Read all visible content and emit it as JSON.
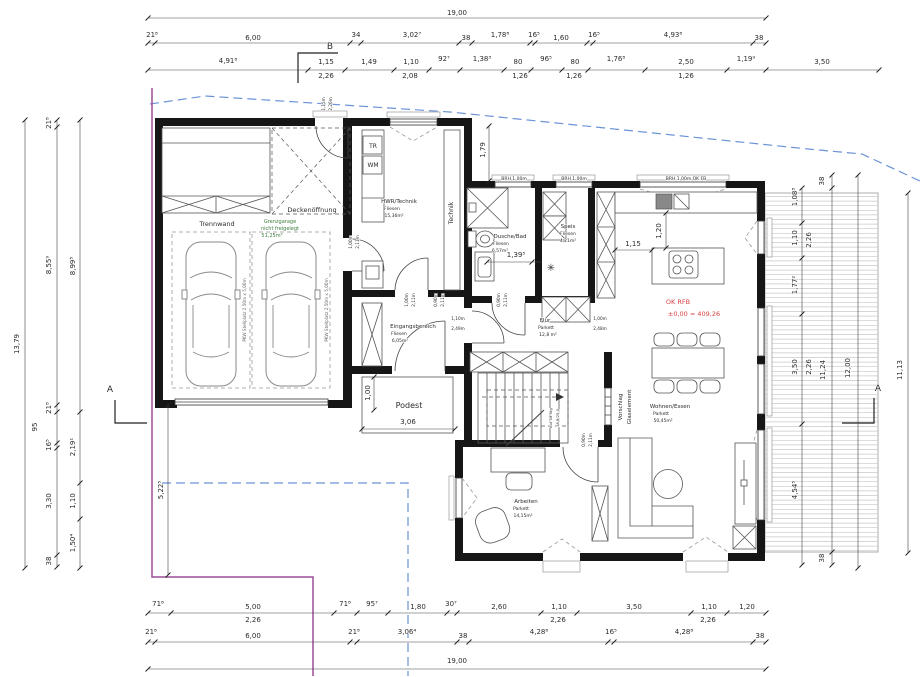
{
  "drawing": {
    "type": "floor-plan",
    "level_note": "OK RFB ±0,00 = 409,26",
    "rooms": [
      {
        "name": "Grenzgarage",
        "note": "nicht freigelegt",
        "area": "51,25m²"
      },
      {
        "name": "HWR/Technik",
        "floor": "Fliesen",
        "area": "15,36m²"
      },
      {
        "name": "Dusche/Bad",
        "floor": "Fliesen",
        "area": "6,57m²"
      },
      {
        "name": "Speis",
        "floor": "Fliesen",
        "area": "4,21m²"
      },
      {
        "name": "Flur",
        "floor": "Parkett",
        "area": "12,8 m²"
      },
      {
        "name": "Eingangsbereich",
        "floor": "Fliesen",
        "area": "6,05m²"
      },
      {
        "name": "Wohnen/Essen",
        "floor": "Parkett",
        "area": "50,45m²"
      },
      {
        "name": "Arbeiten",
        "floor": "Parkett",
        "area": "14,15m²"
      }
    ],
    "colors": {
      "boundary_purple": "#9b4f96",
      "site_blue": "#6b93d6",
      "note_red": "#d84040",
      "garage_green": "#3e7d3e"
    }
  },
  "labels": [
    {
      "t": "19,00",
      "x": 457,
      "y": 15
    },
    {
      "t": "21⁸",
      "x": 152,
      "y": 37
    },
    {
      "t": "6,00",
      "x": 253,
      "y": 40
    },
    {
      "t": "34",
      "x": 356,
      "y": 37
    },
    {
      "t": "3,02⁷",
      "x": 412,
      "y": 37
    },
    {
      "t": "38",
      "x": 466,
      "y": 40
    },
    {
      "t": "1,78⁸",
      "x": 500,
      "y": 37
    },
    {
      "t": "16⁵",
      "x": 534,
      "y": 37
    },
    {
      "t": "1,60",
      "x": 561,
      "y": 40
    },
    {
      "t": "16⁵",
      "x": 594,
      "y": 37
    },
    {
      "t": "4,93⁸",
      "x": 673,
      "y": 37
    },
    {
      "t": "38",
      "x": 759,
      "y": 40
    },
    {
      "t": "B",
      "x": 330,
      "y": 49,
      "s": 9,
      "n": "section-marker-b-label"
    },
    {
      "t": "4,91⁸",
      "x": 228,
      "y": 63
    },
    {
      "t": "1,15",
      "x": 326,
      "y": 64
    },
    {
      "t": "2,26",
      "x": 326,
      "y": 78
    },
    {
      "t": "1,49",
      "x": 369,
      "y": 64
    },
    {
      "t": "1,10",
      "x": 411,
      "y": 64
    },
    {
      "t": "2,08",
      "x": 410,
      "y": 78
    },
    {
      "t": "92⁷",
      "x": 444,
      "y": 61
    },
    {
      "t": "1,38³",
      "x": 482,
      "y": 61
    },
    {
      "t": "80",
      "x": 518,
      "y": 64
    },
    {
      "t": "1,26",
      "x": 520,
      "y": 78
    },
    {
      "t": "96⁵",
      "x": 546,
      "y": 61
    },
    {
      "t": "80",
      "x": 575,
      "y": 64
    },
    {
      "t": "1,26",
      "x": 574,
      "y": 78
    },
    {
      "t": "1,76⁸",
      "x": 616,
      "y": 61
    },
    {
      "t": "2,50",
      "x": 686,
      "y": 64
    },
    {
      "t": "1,26",
      "x": 686,
      "y": 78
    },
    {
      "t": "1,19⁹",
      "x": 746,
      "y": 61
    },
    {
      "t": "3,50",
      "x": 822,
      "y": 64
    },
    {
      "t": "13,79",
      "x": 19,
      "y": 344,
      "r": -90
    },
    {
      "t": "21⁸",
      "x": 51,
      "y": 123,
      "r": -90
    },
    {
      "t": "8,55⁹",
      "x": 51,
      "y": 265,
      "r": -90
    },
    {
      "t": "21⁸",
      "x": 51,
      "y": 408,
      "r": -90
    },
    {
      "t": "95",
      "x": 37,
      "y": 427,
      "r": -90
    },
    {
      "t": "16⁵",
      "x": 51,
      "y": 445,
      "r": -90
    },
    {
      "t": "3,30",
      "x": 51,
      "y": 501,
      "r": -90
    },
    {
      "t": "38",
      "x": 51,
      "y": 561,
      "r": -90
    },
    {
      "t": "8,99⁵",
      "x": 75,
      "y": 266,
      "r": -90
    },
    {
      "t": "2,19¹",
      "x": 75,
      "y": 447,
      "r": -90
    },
    {
      "t": "1,10",
      "x": 75,
      "y": 501,
      "r": -90
    },
    {
      "t": "1,50⁴",
      "x": 75,
      "y": 543,
      "r": -90
    },
    {
      "t": "A",
      "x": 110,
      "y": 392,
      "s": 9,
      "n": "section-marker-a-label"
    },
    {
      "t": "5,22⁵",
      "x": 163,
      "y": 490,
      "r": -90
    },
    {
      "t": "38",
      "x": 824,
      "y": 181,
      "r": -90
    },
    {
      "t": "1,08³",
      "x": 797,
      "y": 197,
      "r": -90
    },
    {
      "t": "1,10",
      "x": 797,
      "y": 238,
      "r": -90
    },
    {
      "t": "2,26",
      "x": 811,
      "y": 240,
      "r": -90
    },
    {
      "t": "1,77²",
      "x": 797,
      "y": 285,
      "r": -90
    },
    {
      "t": "3,50",
      "x": 797,
      "y": 367,
      "r": -90
    },
    {
      "t": "2,26",
      "x": 811,
      "y": 367,
      "r": -90
    },
    {
      "t": "11,24",
      "x": 825,
      "y": 370,
      "r": -90
    },
    {
      "t": "12,00",
      "x": 850,
      "y": 368,
      "r": -90
    },
    {
      "t": "11,13",
      "x": 902,
      "y": 370,
      "r": -90
    },
    {
      "t": "4,54⁵",
      "x": 797,
      "y": 490,
      "r": -90
    },
    {
      "t": "38",
      "x": 824,
      "y": 558,
      "r": -90
    },
    {
      "t": "A",
      "x": 878,
      "y": 391,
      "s": 9,
      "n": "section-marker-a-label"
    },
    {
      "t": "71⁸",
      "x": 158,
      "y": 606
    },
    {
      "t": "5,00",
      "x": 253,
      "y": 609
    },
    {
      "t": "2,26",
      "x": 253,
      "y": 622
    },
    {
      "t": "71⁸",
      "x": 345,
      "y": 606
    },
    {
      "t": "95⁷",
      "x": 372,
      "y": 606
    },
    {
      "t": "1,80",
      "x": 418,
      "y": 609
    },
    {
      "t": "30⁷",
      "x": 451,
      "y": 606
    },
    {
      "t": "2,60",
      "x": 499,
      "y": 609
    },
    {
      "t": "1,10",
      "x": 559,
      "y": 609
    },
    {
      "t": "2,26",
      "x": 558,
      "y": 622
    },
    {
      "t": "3,50",
      "x": 634,
      "y": 609
    },
    {
      "t": "1,10",
      "x": 709,
      "y": 609
    },
    {
      "t": "2,26",
      "x": 708,
      "y": 622
    },
    {
      "t": "1,20",
      "x": 747,
      "y": 609
    },
    {
      "t": "21⁸",
      "x": 151,
      "y": 634
    },
    {
      "t": "6,00",
      "x": 253,
      "y": 638
    },
    {
      "t": "21⁸",
      "x": 354,
      "y": 634
    },
    {
      "t": "3,06⁴",
      "x": 407,
      "y": 634
    },
    {
      "t": "38",
      "x": 463,
      "y": 638
    },
    {
      "t": "4,28⁸",
      "x": 539,
      "y": 634
    },
    {
      "t": "16⁵",
      "x": 611,
      "y": 634
    },
    {
      "t": "4,28⁸",
      "x": 684,
      "y": 634
    },
    {
      "t": "38",
      "x": 760,
      "y": 638
    },
    {
      "t": "19,00",
      "x": 457,
      "y": 663
    },
    {
      "t": "1,79",
      "x": 485,
      "y": 150,
      "r": -90
    },
    {
      "t": "1,20",
      "x": 661,
      "y": 231,
      "r": -90
    },
    {
      "t": "1,15",
      "x": 633,
      "y": 246
    },
    {
      "t": "1,39⁵",
      "x": 516,
      "y": 257
    },
    {
      "t": "1,00",
      "x": 370,
      "y": 393,
      "r": -90
    },
    {
      "t": "Podest",
      "x": 409,
      "y": 408,
      "s": 8,
      "n": "room-label"
    },
    {
      "t": "3,06",
      "x": 408,
      "y": 424
    },
    {
      "t": "OK RFB",
      "x": 678,
      "y": 304,
      "s": 6.5,
      "c": "#d84040",
      "n": "level-note"
    },
    {
      "t": "±0,00 = 409,26",
      "x": 694,
      "y": 316,
      "s": 6.5,
      "c": "#d84040",
      "n": "level-note"
    },
    {
      "t": "Trennwand",
      "x": 217,
      "y": 226,
      "s": 6.5,
      "n": "room-label"
    },
    {
      "t": "Grenzgarage",
      "x": 280,
      "y": 223,
      "s": 5,
      "c": "#3e7d3e",
      "n": "room-label"
    },
    {
      "t": "nicht freigelegt",
      "x": 280,
      "y": 230,
      "s": 5,
      "c": "#3e7d3e",
      "n": "room-label"
    },
    {
      "t": "51,25m²",
      "x": 272,
      "y": 237,
      "s": 5,
      "c": "#3e7d3e",
      "n": "room-label"
    },
    {
      "t": "Deckenöffnung",
      "x": 312,
      "y": 212,
      "s": 6.5,
      "n": "room-label"
    },
    {
      "t": "HWR/Technik",
      "x": 399,
      "y": 203,
      "s": 5.5,
      "n": "room-label"
    },
    {
      "t": "Fliesen",
      "x": 392,
      "y": 210,
      "s": 4.5,
      "n": "room-label"
    },
    {
      "t": "15,36m²",
      "x": 394,
      "y": 217,
      "s": 4.5,
      "n": "room-label"
    },
    {
      "t": "Technik",
      "x": 453,
      "y": 213,
      "r": -90,
      "s": 6,
      "n": "room-label"
    },
    {
      "t": "TR",
      "x": 373,
      "y": 148,
      "s": 6,
      "n": "fixture-label"
    },
    {
      "t": "WM",
      "x": 373,
      "y": 167,
      "s": 6,
      "n": "fixture-label"
    },
    {
      "t": "Dusche/Bad",
      "x": 510,
      "y": 238,
      "s": 5.5,
      "n": "room-label"
    },
    {
      "t": "Fliesen",
      "x": 501,
      "y": 245,
      "s": 4.5,
      "n": "room-label"
    },
    {
      "t": "6,57m²",
      "x": 500,
      "y": 252,
      "s": 4.5,
      "n": "room-label"
    },
    {
      "t": "Speis",
      "x": 568,
      "y": 228,
      "s": 5.5,
      "n": "room-label"
    },
    {
      "t": "Fliesen",
      "x": 568,
      "y": 235,
      "s": 4.5,
      "n": "room-label"
    },
    {
      "t": "4,21m²",
      "x": 568,
      "y": 242,
      "s": 4.5,
      "n": "room-label"
    },
    {
      "t": "Flur",
      "x": 545,
      "y": 322,
      "s": 5.5,
      "n": "room-label"
    },
    {
      "t": "Parkett",
      "x": 546,
      "y": 329,
      "s": 4.5,
      "n": "room-label"
    },
    {
      "t": "12,8 m²",
      "x": 548,
      "y": 336,
      "s": 4.5,
      "n": "room-label"
    },
    {
      "t": "Eingangsbereich",
      "x": 413,
      "y": 328,
      "s": 5.5,
      "n": "room-label"
    },
    {
      "t": "Fliesen",
      "x": 399,
      "y": 335,
      "s": 4.5,
      "n": "room-label"
    },
    {
      "t": "6,05m²",
      "x": 400,
      "y": 342,
      "s": 4.5,
      "n": "room-label"
    },
    {
      "t": "Wohnen/Essen",
      "x": 670,
      "y": 408,
      "s": 5.5,
      "n": "room-label"
    },
    {
      "t": "Parkett",
      "x": 661,
      "y": 415,
      "s": 4.5,
      "n": "room-label"
    },
    {
      "t": "50,45m²",
      "x": 663,
      "y": 422,
      "s": 4.5,
      "n": "room-label"
    },
    {
      "t": "Arbeiten",
      "x": 526,
      "y": 503,
      "s": 5.5,
      "n": "room-label"
    },
    {
      "t": "Parkett",
      "x": 521,
      "y": 510,
      "s": 4.5,
      "n": "room-label"
    },
    {
      "t": "14,15m²",
      "x": 523,
      "y": 517,
      "s": 4.5,
      "n": "room-label"
    },
    {
      "t": "Vorschlag",
      "x": 622,
      "y": 407,
      "r": -90,
      "s": 5.5,
      "n": "note"
    },
    {
      "t": "Glaselement",
      "x": 631,
      "y": 407,
      "r": -90,
      "s": 5.5,
      "n": "note"
    },
    {
      "t": "PKW Stellplatz 2,50m x 5,00m",
      "x": 246,
      "y": 310,
      "r": -90,
      "s": 4.2,
      "c": "#666",
      "n": "parking-label"
    },
    {
      "t": "PKW Stellplatz 2,50m x 5,00m",
      "x": 328,
      "y": 310,
      "r": -90,
      "s": 4.2,
      "c": "#666",
      "n": "parking-label"
    },
    {
      "t": "1,15m",
      "x": 325,
      "y": 104,
      "r": -90,
      "s": 4.2,
      "n": "opening-label"
    },
    {
      "t": "2,26m",
      "x": 332,
      "y": 104,
      "r": -90,
      "s": 4.2,
      "n": "opening-label"
    },
    {
      "t": "1,00m",
      "x": 352,
      "y": 242,
      "r": -90,
      "s": 4.2,
      "n": "opening-label"
    },
    {
      "t": "2,11m",
      "x": 359,
      "y": 242,
      "r": -90,
      "s": 4.2,
      "n": "opening-label"
    },
    {
      "t": "1,00m",
      "x": 408,
      "y": 300,
      "r": -90,
      "s": 4.2,
      "n": "opening-label"
    },
    {
      "t": "2,11m",
      "x": 415,
      "y": 300,
      "r": -90,
      "s": 4.2,
      "n": "opening-label"
    },
    {
      "t": "0,90m",
      "x": 437,
      "y": 300,
      "r": -90,
      "s": 4.2,
      "n": "opening-label"
    },
    {
      "t": "2,11m",
      "x": 444,
      "y": 300,
      "r": -90,
      "s": 4.2,
      "n": "opening-label"
    },
    {
      "t": "0,90m",
      "x": 500,
      "y": 300,
      "r": -90,
      "s": 4.2,
      "n": "opening-label"
    },
    {
      "t": "2,11m",
      "x": 507,
      "y": 300,
      "r": -90,
      "s": 4.2,
      "n": "opening-label"
    },
    {
      "t": "1,10m",
      "x": 458,
      "y": 320,
      "s": 4.2,
      "n": "opening-label"
    },
    {
      "t": "2,49m",
      "x": 458,
      "y": 330,
      "s": 4.2,
      "n": "opening-label"
    },
    {
      "t": "1,00m",
      "x": 600,
      "y": 320,
      "s": 4.2,
      "n": "opening-label"
    },
    {
      "t": "2,48m",
      "x": 600,
      "y": 330,
      "s": 4.2,
      "n": "opening-label"
    },
    {
      "t": "0,90m",
      "x": 585,
      "y": 440,
      "r": -90,
      "s": 4.2,
      "n": "opening-label"
    },
    {
      "t": "2,11m",
      "x": 592,
      "y": 440,
      "r": -90,
      "s": 4.2,
      "n": "opening-label"
    },
    {
      "t": "BRH 1,00m",
      "x": 514,
      "y": 180,
      "s": 4.5,
      "n": "window-label"
    },
    {
      "t": "BRH 1,00m",
      "x": 574,
      "y": 180,
      "s": 4.5,
      "n": "window-label"
    },
    {
      "t": "BRH 1,00m OK FB",
      "x": 686,
      "y": 180,
      "s": 4.5,
      "n": "window-label"
    },
    {
      "t": "Auf 18 Stg",
      "x": 552,
      "y": 418,
      "r": -90,
      "s": 3.8,
      "n": "stair-label"
    },
    {
      "t": "18,8/25,0",
      "x": 559,
      "y": 418,
      "r": -90,
      "s": 3.8,
      "n": "stair-label"
    },
    {
      "t": "✳",
      "x": 551,
      "y": 271,
      "s": 10,
      "c": "#333",
      "n": "symbol"
    }
  ]
}
